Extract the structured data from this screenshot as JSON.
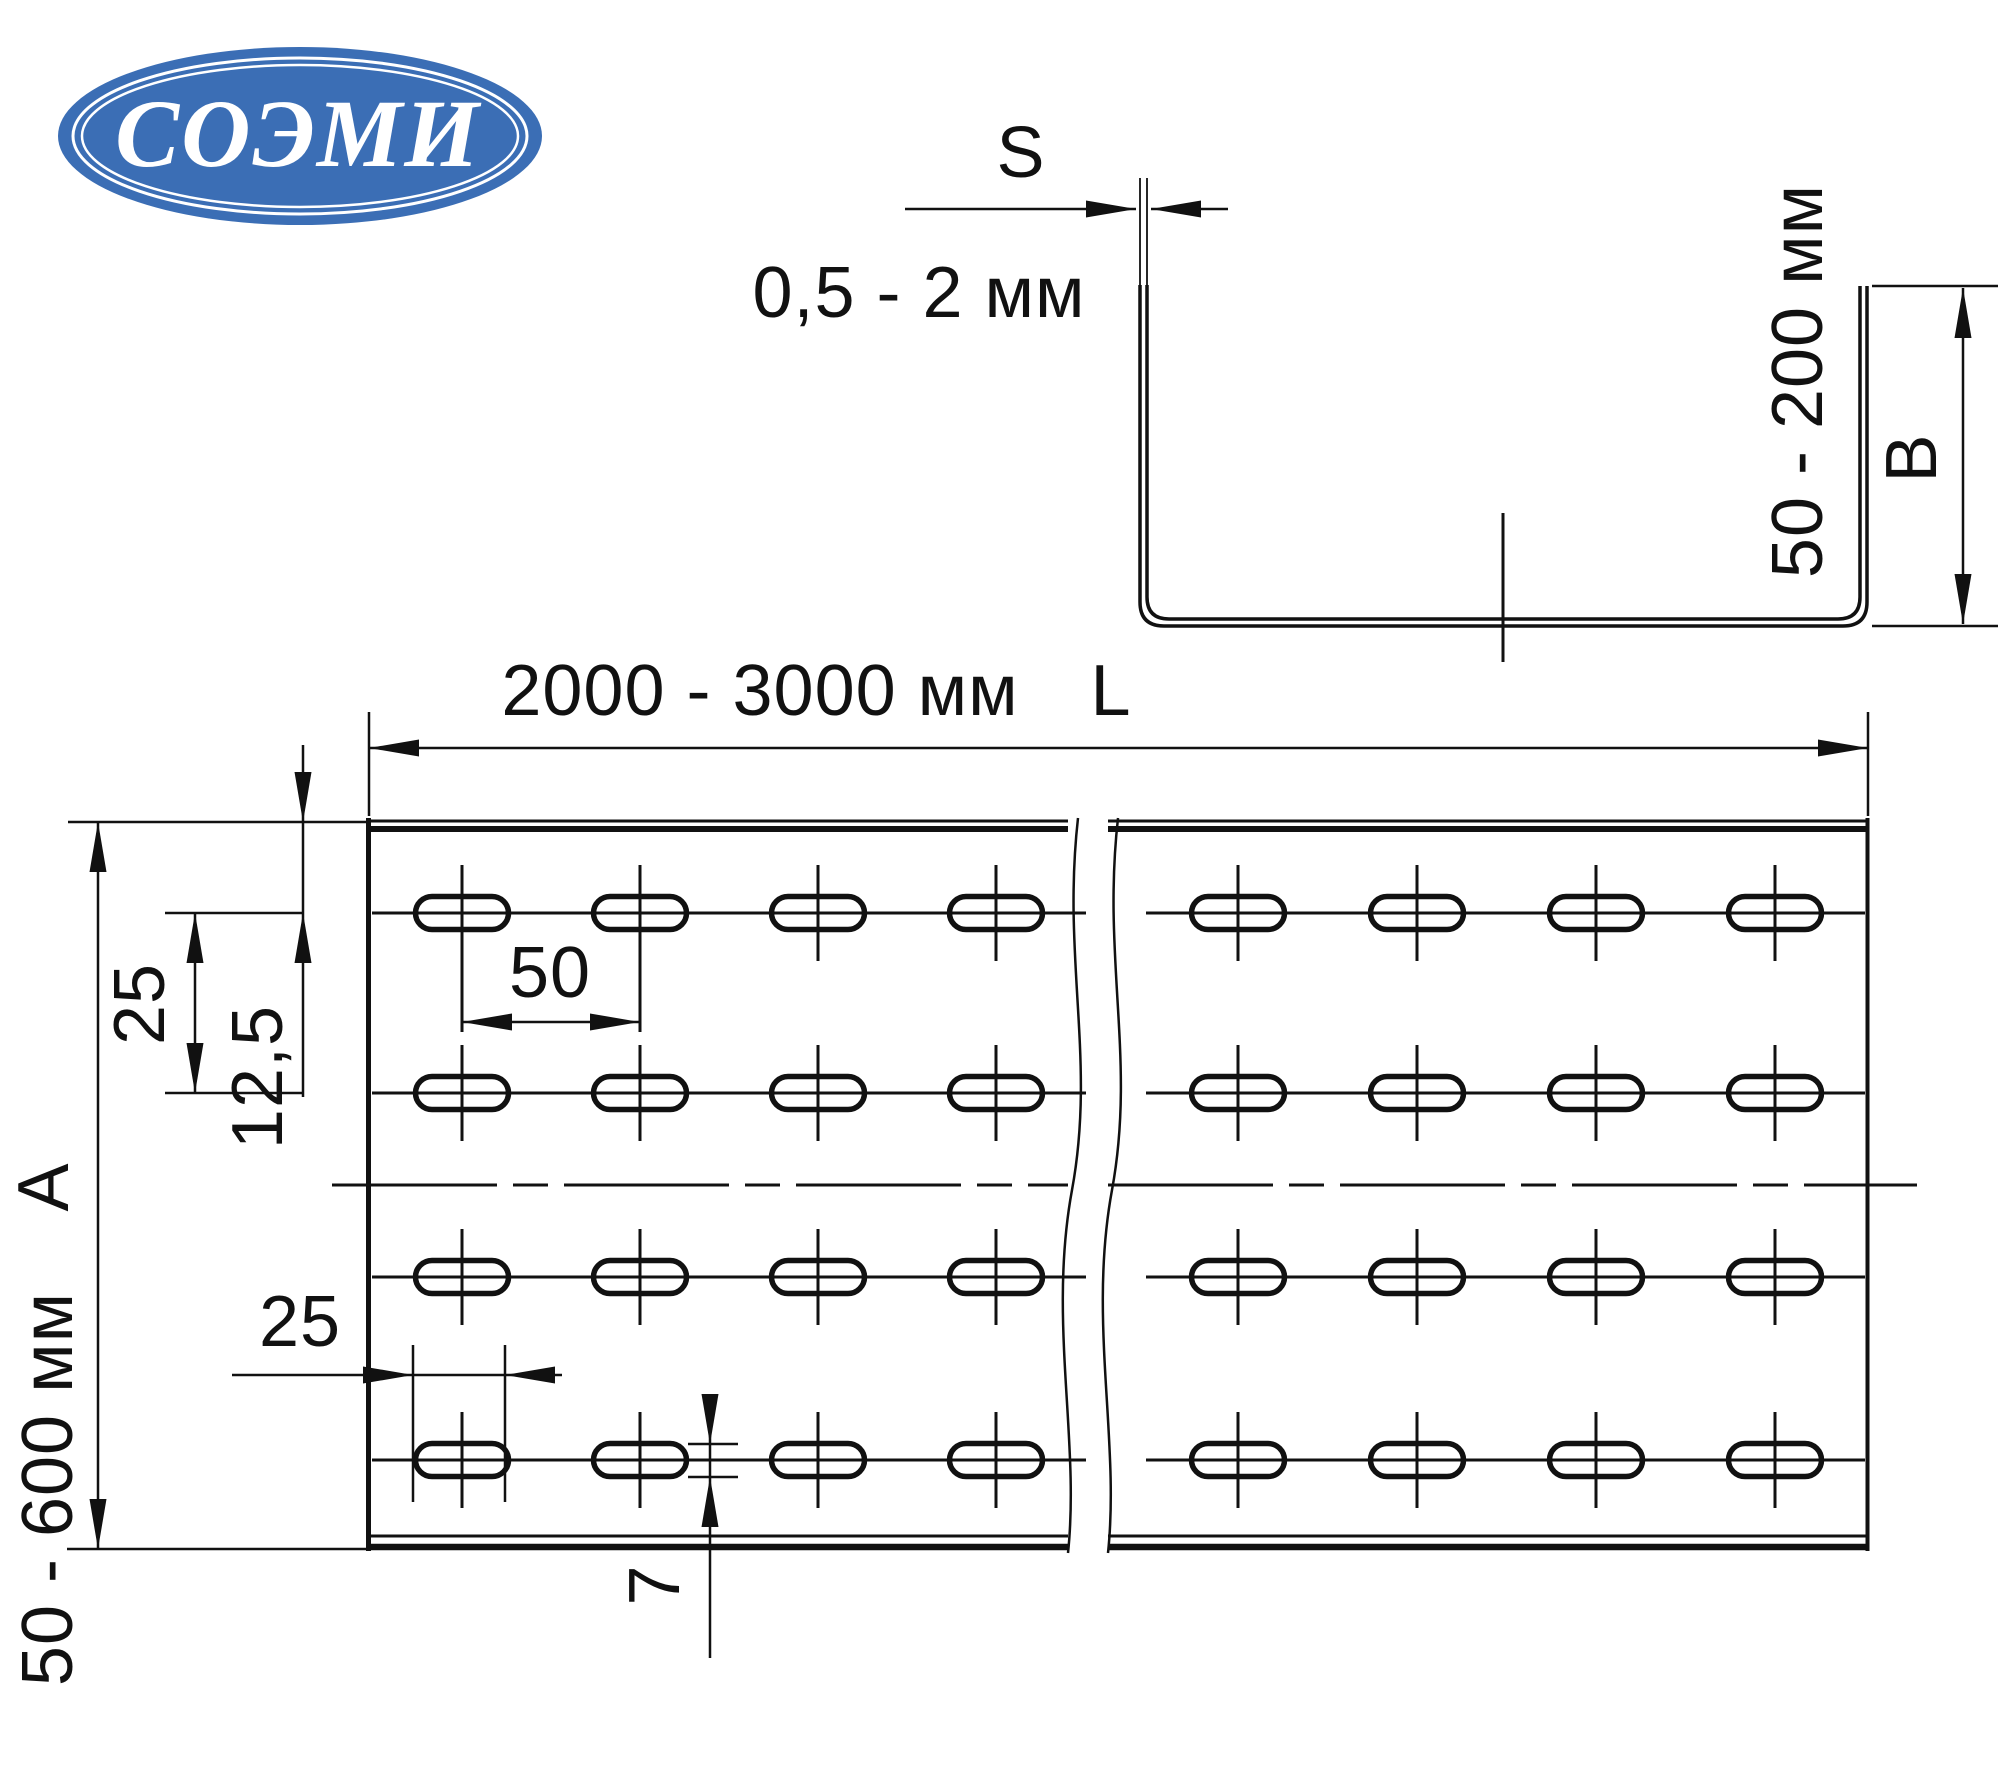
{
  "logo": {
    "text": "СОЭМИ",
    "bg_color": "#3b6eb5",
    "text_color": "#ffffff"
  },
  "cross_section": {
    "thickness_letter": "S",
    "thickness_range": "0,5 - 2 мм",
    "height_range": "50 - 200 мм",
    "height_letter": "B"
  },
  "top_view": {
    "length_range": "2000 - 3000 мм",
    "length_letter": "L",
    "width_range": "50 - 600 мм",
    "width_letter": "A",
    "row_spacing": "25",
    "edge_offset": "12,5",
    "slot_pitch": "50",
    "slot_length": "25",
    "slot_width": "7",
    "perforation": {
      "rows": 4,
      "visible_columns": 8
    }
  },
  "line_color": "#111111"
}
